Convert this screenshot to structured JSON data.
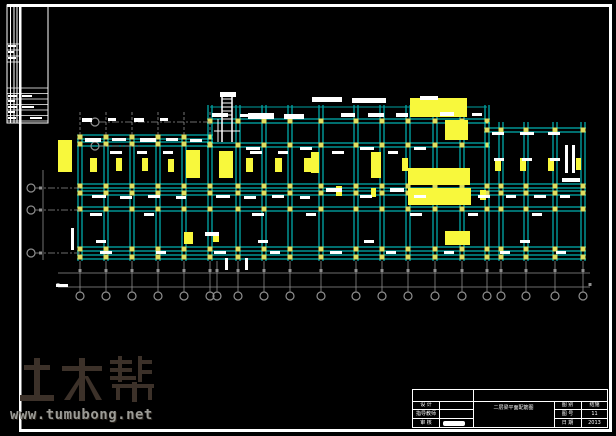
{
  "colors": {
    "beam": "#00dcdc",
    "beam_dim": "#00a0a0",
    "grid": "#8f8f8f",
    "column": "#dede60",
    "highlight": "#f8f83c",
    "white": "#ffffff",
    "frame": "#ffffff",
    "watermark_logo": "#3c3129",
    "watermark_url": "#9b9b96"
  },
  "watermark": {
    "logo_text": "土木帮",
    "url": "www.tumubong.net"
  },
  "title_block": {
    "left_rows": [
      {
        "label": "设 计",
        "value": ""
      },
      {
        "label": "指导教师",
        "value": ""
      },
      {
        "label": "审 核",
        "value": ""
      }
    ],
    "title": "二层梁平面配筋图",
    "right_rows": [
      {
        "label": "图 别",
        "value": "结施"
      },
      {
        "label": "图 号",
        "value": "11"
      },
      {
        "label": "日 期",
        "value": "2013"
      }
    ]
  },
  "plan": {
    "frame": {
      "top": 5,
      "bottom": 430,
      "left": 20,
      "right": 610,
      "strip_left": 7
    },
    "strip": {
      "x1": 7,
      "x2": 48,
      "y1": 5,
      "y2": 123,
      "vlines": [
        10.5,
        14,
        17,
        20
      ],
      "upper_ys": [
        44,
        50,
        56,
        62
      ],
      "lower_ys": [
        88,
        93.5,
        99,
        104.5,
        110,
        115.5,
        121
      ],
      "marks": [
        [
          8,
          45,
          8,
          2
        ],
        [
          8,
          51,
          6,
          2
        ],
        [
          8,
          57,
          8,
          2
        ],
        [
          8,
          95,
          9,
          2
        ],
        [
          8,
          100,
          7,
          2
        ],
        [
          8,
          106,
          9,
          2
        ],
        [
          8,
          111,
          7,
          2
        ],
        [
          8,
          117,
          8,
          2
        ],
        [
          22,
          95,
          10,
          2
        ],
        [
          22,
          106,
          12,
          2
        ],
        [
          30,
          117,
          12,
          2
        ]
      ]
    },
    "sections": [
      {
        "x1": 80,
        "x2": 210,
        "cols": [
          80,
          106,
          132,
          158,
          184,
          210
        ],
        "rows": [
          137,
          144,
          186,
          193,
          209,
          249,
          257
        ],
        "top": 135,
        "dash_above": true
      },
      {
        "x1": 210,
        "x2": 487,
        "cols": [
          210,
          238,
          264,
          290,
          321,
          356,
          382,
          408,
          435,
          462,
          487
        ],
        "rows": [
          121,
          145,
          186,
          193,
          209,
          249,
          257
        ],
        "top": 105,
        "dash_above": false
      },
      {
        "x1": 487,
        "x2": 583,
        "cols": [
          487,
          501,
          526,
          555,
          583
        ],
        "rows": [
          130,
          186,
          193,
          209,
          249,
          257
        ],
        "top": 122,
        "dash_above": false
      }
    ],
    "beam_bottom": 261,
    "canopy": {
      "y": 107,
      "x1": 210,
      "x2": 487
    },
    "bottom_bubbles": {
      "y": 296,
      "leader_y1": 261,
      "leader_y2": 292,
      "xs": [
        80,
        106,
        132,
        158,
        184,
        210,
        217,
        238,
        264,
        290,
        321,
        356,
        382,
        408,
        435,
        462,
        487,
        501,
        526,
        555,
        583
      ]
    },
    "left_bubbles": [
      {
        "x": 95,
        "y": 122,
        "x2": 210
      },
      {
        "x": 95,
        "y": 146,
        "x2": 140
      },
      {
        "x": 31,
        "y": 188,
        "x2": 80
      },
      {
        "x": 31,
        "y": 210,
        "x2": 80
      },
      {
        "x": 31,
        "y": 253,
        "x2": 80
      }
    ],
    "dim_h": [
      {
        "y": 273,
        "x1": 58,
        "x2": 590,
        "ticks": "cols"
      },
      {
        "y": 287,
        "x1": 58,
        "x2": 590,
        "ticks": [
          58,
          590
        ]
      }
    ],
    "dim_v": {
      "x": 43,
      "y1": 170,
      "y2": 260,
      "ticks": [
        188,
        210,
        253
      ]
    },
    "stair": {
      "x1": 222,
      "x2": 232,
      "y1": 96,
      "y2": 142,
      "treads": [
        99,
        103,
        107,
        111,
        115,
        119
      ],
      "extra_v": [
        [
          218,
          119,
          218,
          142
        ]
      ],
      "extra_h": [
        [
          214,
          131,
          240,
          131
        ]
      ]
    },
    "yellow_rects": [
      [
        58,
        140,
        14,
        32
      ],
      [
        90,
        158,
        7,
        14
      ],
      [
        116,
        158,
        6,
        13
      ],
      [
        142,
        158,
        6,
        13
      ],
      [
        168,
        159,
        6,
        13
      ],
      [
        186,
        150,
        14,
        28
      ],
      [
        219,
        151,
        14,
        27
      ],
      [
        246,
        158,
        7,
        14
      ],
      [
        275,
        158,
        7,
        14
      ],
      [
        304,
        158,
        7,
        14
      ],
      [
        311,
        152,
        8,
        21
      ],
      [
        371,
        152,
        10,
        26
      ],
      [
        402,
        158,
        6,
        13
      ],
      [
        410,
        98,
        57,
        19
      ],
      [
        445,
        120,
        23,
        20
      ],
      [
        408,
        168,
        62,
        17
      ],
      [
        408,
        188,
        63,
        17
      ],
      [
        445,
        231,
        25,
        14
      ],
      [
        336,
        186,
        6,
        10
      ],
      [
        371,
        188,
        5,
        9
      ],
      [
        480,
        190,
        6,
        10
      ],
      [
        495,
        158,
        6,
        13
      ],
      [
        520,
        158,
        6,
        13
      ],
      [
        548,
        158,
        6,
        13
      ],
      [
        576,
        158,
        5,
        12
      ],
      [
        184,
        232,
        9,
        12
      ],
      [
        213,
        232,
        6,
        10
      ]
    ],
    "white_marks": [
      [
        212,
        113,
        16,
        4
      ],
      [
        240,
        114,
        12,
        3
      ],
      [
        248,
        113,
        26,
        6
      ],
      [
        284,
        114,
        20,
        5
      ],
      [
        312,
        97,
        30,
        5
      ],
      [
        352,
        98,
        34,
        5
      ],
      [
        341,
        113,
        14,
        4
      ],
      [
        368,
        113,
        16,
        4
      ],
      [
        396,
        113,
        12,
        4
      ],
      [
        420,
        96,
        18,
        4
      ],
      [
        440,
        112,
        14,
        4
      ],
      [
        472,
        113,
        10,
        3
      ],
      [
        82,
        118,
        10,
        4
      ],
      [
        108,
        118,
        8,
        3
      ],
      [
        134,
        118,
        10,
        4
      ],
      [
        160,
        118,
        8,
        3
      ],
      [
        85,
        138,
        16,
        4
      ],
      [
        112,
        138,
        14,
        3
      ],
      [
        140,
        138,
        16,
        4
      ],
      [
        166,
        138,
        12,
        3
      ],
      [
        190,
        139,
        12,
        3
      ],
      [
        246,
        147,
        14,
        3
      ],
      [
        300,
        147,
        12,
        3
      ],
      [
        360,
        147,
        14,
        3
      ],
      [
        414,
        147,
        12,
        3
      ],
      [
        492,
        132,
        12,
        3
      ],
      [
        520,
        132,
        14,
        3
      ],
      [
        548,
        132,
        12,
        3
      ],
      [
        110,
        151,
        12,
        3
      ],
      [
        137,
        151,
        10,
        3
      ],
      [
        163,
        151,
        10,
        3
      ],
      [
        250,
        151,
        12,
        3
      ],
      [
        278,
        151,
        10,
        3
      ],
      [
        332,
        151,
        12,
        3
      ],
      [
        388,
        151,
        10,
        3
      ],
      [
        494,
        158,
        10,
        3
      ],
      [
        522,
        158,
        10,
        3
      ],
      [
        550,
        158,
        10,
        3
      ],
      [
        92,
        195,
        14,
        3
      ],
      [
        120,
        196,
        12,
        3
      ],
      [
        148,
        195,
        12,
        3
      ],
      [
        176,
        196,
        10,
        3
      ],
      [
        216,
        195,
        14,
        3
      ],
      [
        244,
        196,
        12,
        3
      ],
      [
        272,
        195,
        12,
        3
      ],
      [
        300,
        196,
        10,
        3
      ],
      [
        326,
        188,
        16,
        4
      ],
      [
        360,
        195,
        12,
        3
      ],
      [
        390,
        188,
        14,
        4
      ],
      [
        414,
        195,
        12,
        3
      ],
      [
        478,
        195,
        12,
        3
      ],
      [
        506,
        195,
        10,
        3
      ],
      [
        534,
        195,
        12,
        3
      ],
      [
        560,
        195,
        10,
        3
      ],
      [
        90,
        213,
        12,
        3
      ],
      [
        144,
        213,
        10,
        3
      ],
      [
        252,
        213,
        12,
        3
      ],
      [
        306,
        213,
        10,
        3
      ],
      [
        410,
        213,
        12,
        3
      ],
      [
        468,
        213,
        10,
        3
      ],
      [
        532,
        213,
        10,
        3
      ],
      [
        71,
        228,
        3,
        22
      ],
      [
        96,
        240,
        10,
        3
      ],
      [
        205,
        232,
        14,
        4
      ],
      [
        258,
        240,
        10,
        3
      ],
      [
        364,
        240,
        10,
        3
      ],
      [
        520,
        240,
        10,
        3
      ],
      [
        100,
        251,
        12,
        3
      ],
      [
        156,
        251,
        10,
        3
      ],
      [
        214,
        251,
        12,
        3
      ],
      [
        270,
        251,
        10,
        3
      ],
      [
        330,
        251,
        12,
        3
      ],
      [
        386,
        251,
        10,
        3
      ],
      [
        444,
        251,
        10,
        3
      ],
      [
        500,
        251,
        10,
        3
      ],
      [
        556,
        251,
        10,
        3
      ],
      [
        565,
        145,
        3,
        28
      ],
      [
        572,
        145,
        3,
        28
      ],
      [
        562,
        178,
        18,
        4
      ],
      [
        56,
        284,
        12,
        3
      ],
      [
        220,
        92,
        16,
        5
      ],
      [
        225,
        258,
        3,
        12
      ],
      [
        245,
        258,
        3,
        12
      ]
    ]
  }
}
